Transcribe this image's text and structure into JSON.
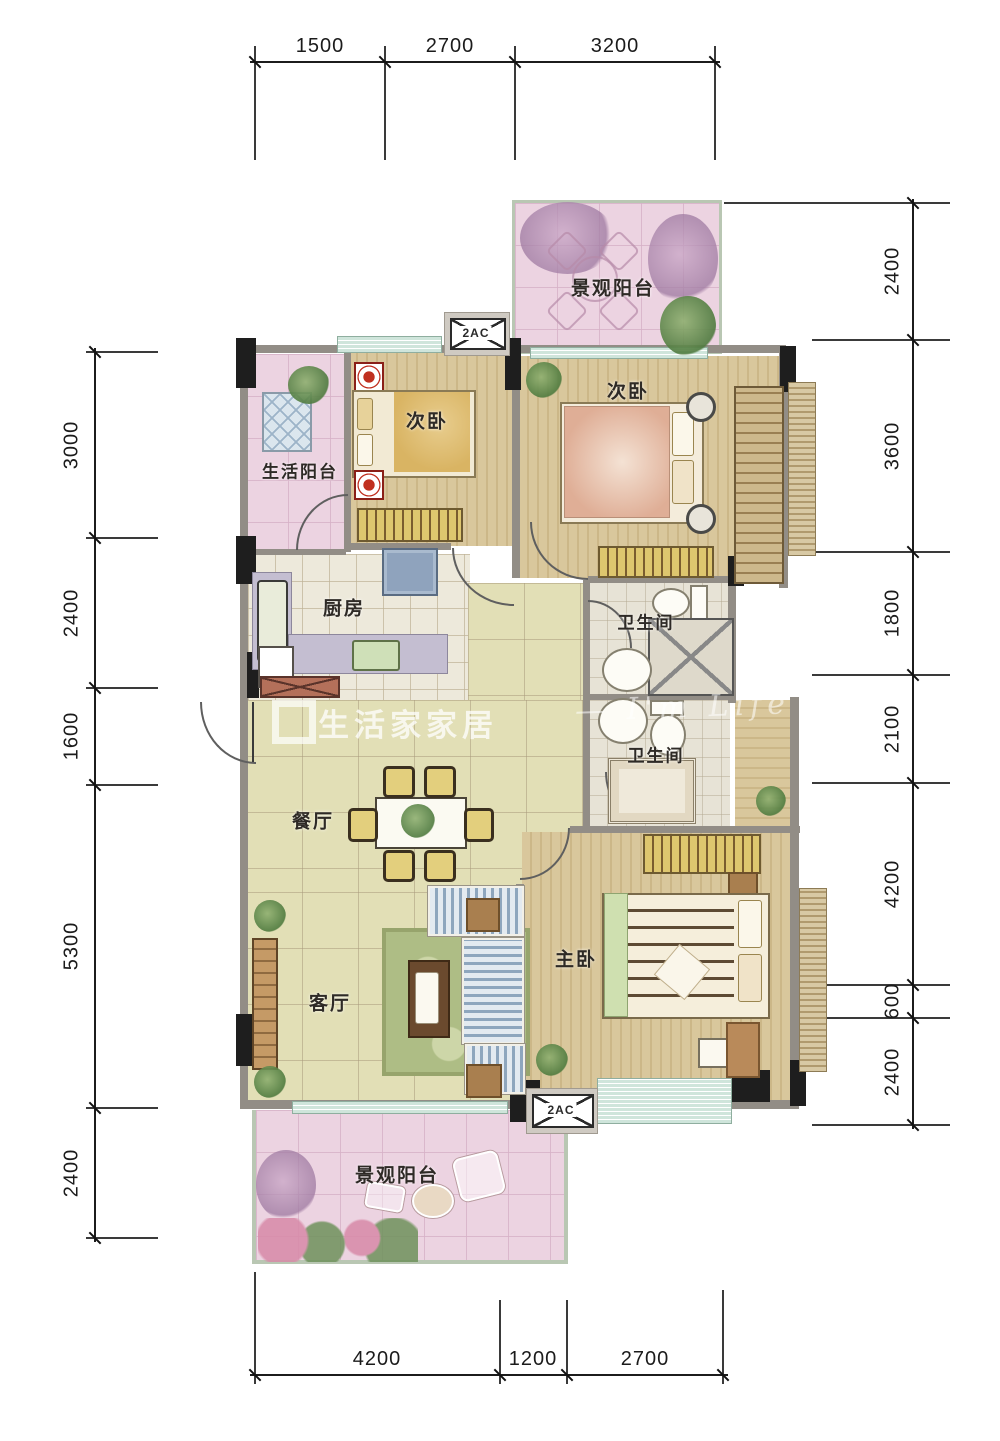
{
  "plan": {
    "title": "apartment-floor-plan",
    "rooms": {
      "balcony_top": "景观阳台",
      "bedroom_a": "次卧",
      "bedroom_b": "次卧",
      "life_balcony": "生活阳台",
      "kitchen": "厨房",
      "bath_a": "卫生间",
      "bath_b": "卫生间",
      "dining": "餐厅",
      "living": "客厅",
      "master": "主卧",
      "balcony_bottom": "景观阳台"
    },
    "ac_label": "2AC",
    "dims": {
      "top": [
        "1500",
        "2700",
        "3200"
      ],
      "bottom": [
        "4200",
        "1200",
        "2700"
      ],
      "left": [
        "3000",
        "2400",
        "1600",
        "5300",
        "2400"
      ],
      "right": [
        "2400",
        "3600",
        "1800",
        "2100",
        "4200",
        "600",
        "2400"
      ]
    },
    "watermark": {
      "brand": "生活家家居",
      "script": "— I'm Life"
    },
    "colors": {
      "balcony_pink": "#ecd3e1",
      "main_tile": "#e2dfb6",
      "wood": "#d6c296",
      "window_teal": "#cfe5db",
      "wall_dark": "#1e1e1e"
    }
  }
}
